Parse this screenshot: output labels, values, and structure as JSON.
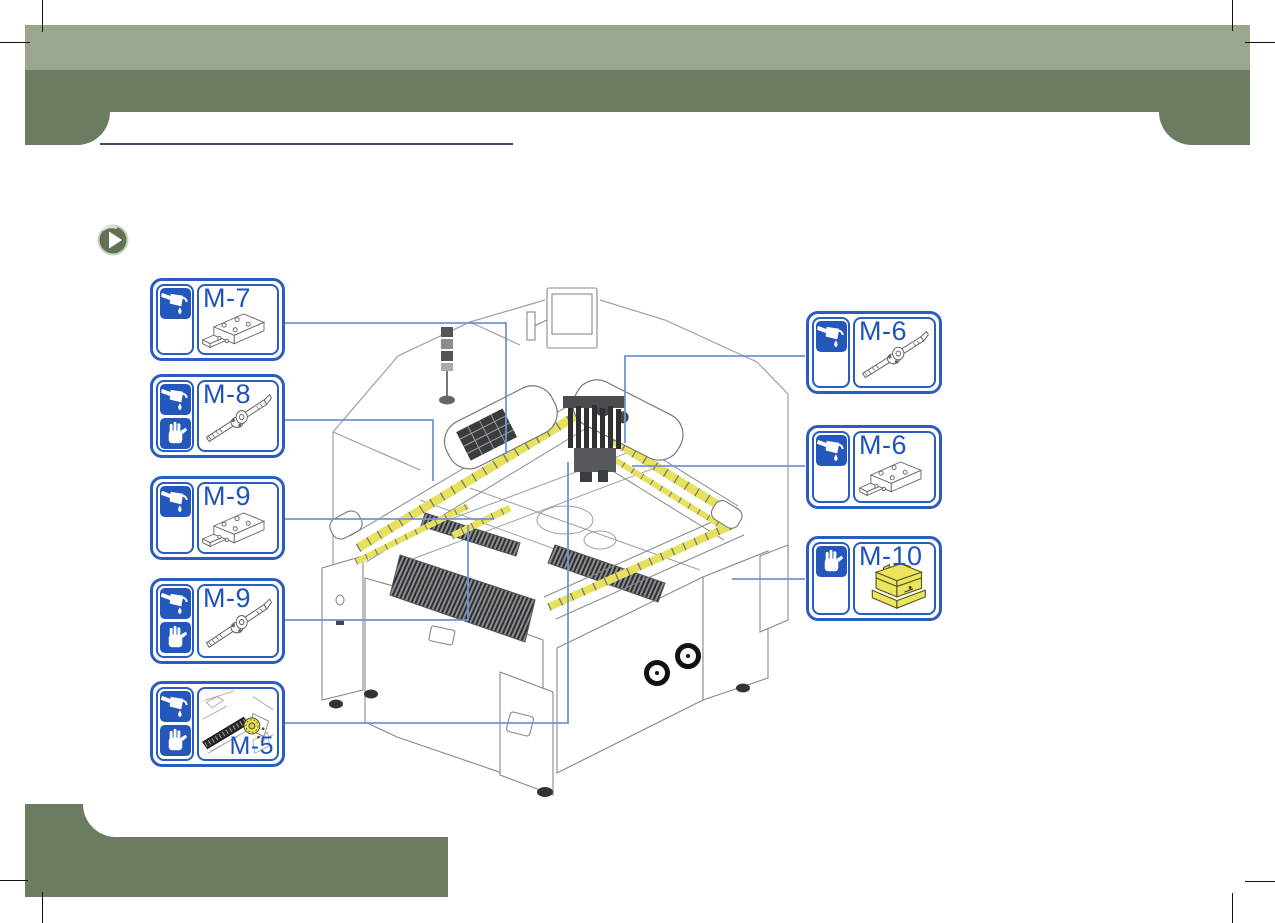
{
  "page": {
    "kind": "maintenance-lubrication-diagram",
    "colors": {
      "header_light_green": "#9aa68d",
      "header_dark_green": "#6c7c61",
      "callout_border_blue": "#2b5cc0",
      "label_blue": "#1d53c0",
      "leader_line_blue": "#6f94d6",
      "rail_highlight_yellow": "#e6e25f",
      "title_underline_navy": "#3c4d63"
    }
  },
  "icons": {
    "oil": "oil-can-lubrication-icon",
    "grease": "grease-hand-icon",
    "bullet": "play-arrow-icon"
  },
  "callouts": [
    {
      "label": "M-7",
      "icons": [
        "oil"
      ],
      "part": "linear-guide-block",
      "side": "left"
    },
    {
      "label": "M-8",
      "icons": [
        "oil",
        "grease"
      ],
      "part": "ball-screw",
      "side": "left"
    },
    {
      "label": "M-9",
      "icons": [
        "oil"
      ],
      "part": "linear-guide-block",
      "side": "left"
    },
    {
      "label": "M-9",
      "icons": [
        "oil",
        "grease"
      ],
      "part": "ball-screw",
      "side": "left"
    },
    {
      "label": "M-5",
      "icons": [
        "oil",
        "grease"
      ],
      "part": "belt-drive-detail",
      "side": "left"
    },
    {
      "label": "M-6",
      "icons": [
        "oil"
      ],
      "part": "ball-screw",
      "side": "right"
    },
    {
      "label": "M-6",
      "icons": [
        "oil"
      ],
      "part": "linear-guide-block",
      "side": "right"
    },
    {
      "label": "M-10",
      "icons": [
        "grease"
      ],
      "part": "grease-unit",
      "side": "right"
    }
  ]
}
